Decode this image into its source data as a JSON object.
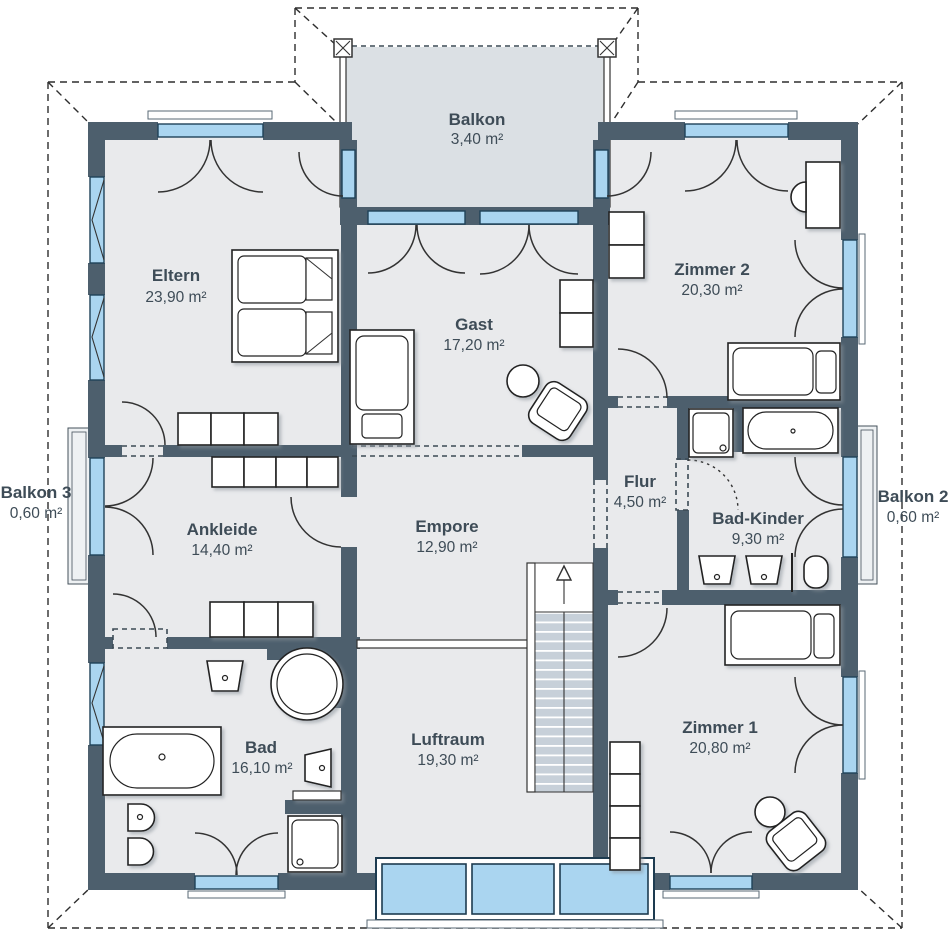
{
  "plan": {
    "rooms": {
      "balkon": {
        "name": "Balkon",
        "area": "3,40 m²"
      },
      "eltern": {
        "name": "Eltern",
        "area": "23,90 m²"
      },
      "zimmer2": {
        "name": "Zimmer 2",
        "area": "20,30 m²"
      },
      "gast": {
        "name": "Gast",
        "area": "17,20 m²"
      },
      "flur": {
        "name": "Flur",
        "area": "4,50 m²"
      },
      "balkon3": {
        "name": "Balkon 3",
        "area": "0,60 m²"
      },
      "balkon2": {
        "name": "Balkon 2",
        "area": "0,60 m²"
      },
      "ankleide": {
        "name": "Ankleide",
        "area": "14,40 m²"
      },
      "empore": {
        "name": "Empore",
        "area": "12,90 m²"
      },
      "bad_kinder": {
        "name": "Bad-Kinder",
        "area": "9,30 m²"
      },
      "bad": {
        "name": "Bad",
        "area": "16,10 m²"
      },
      "luftraum": {
        "name": "Luftraum",
        "area": "19,30 m²"
      },
      "zimmer1": {
        "name": "Zimmer 1",
        "area": "20,80 m²"
      }
    },
    "colors": {
      "wall": "#4d5f6d",
      "floor": "#e9eaec",
      "balcony": "#dbe0e4",
      "glass": "#aad5f0",
      "step": "#c7d0d9",
      "text": "#3e4c57"
    }
  }
}
